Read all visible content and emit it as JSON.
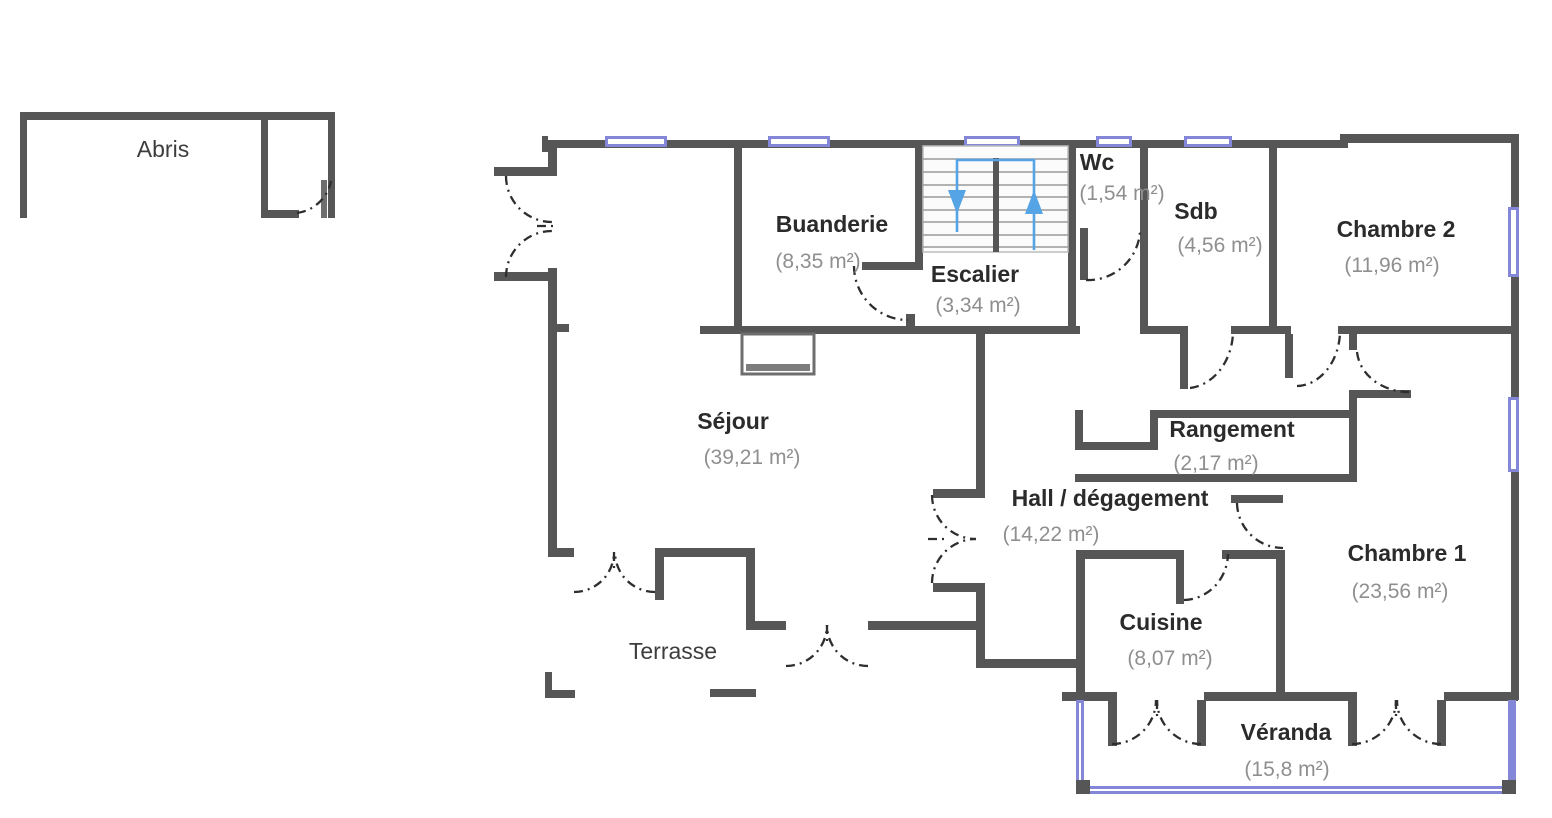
{
  "plan": {
    "outbuilding_label": "Abris",
    "terrace_label": "Terrasse",
    "rooms": [
      {
        "name": "Buanderie",
        "area": "(8,35 m²)"
      },
      {
        "name": "Escalier",
        "area": "(3,34 m²)"
      },
      {
        "name": "Wc",
        "area": "(1,54 m²)"
      },
      {
        "name": "Sdb",
        "area": "(4,56 m²)"
      },
      {
        "name": "Chambre 2",
        "area": "(11,96 m²)"
      },
      {
        "name": "Séjour",
        "area": "(39,21 m²)"
      },
      {
        "name": "Rangement",
        "area": "(2,17 m²)"
      },
      {
        "name": "Hall / dégagement",
        "area": "(14,22 m²)"
      },
      {
        "name": "Chambre 1",
        "area": "(23,56 m²)"
      },
      {
        "name": "Cuisine",
        "area": "(8,07 m²)"
      },
      {
        "name": "Véranda",
        "area": "(15,8 m²)"
      }
    ],
    "colors": {
      "wall": "#565656",
      "window_blue": "#8486d8",
      "stair_arrow_blue": "#55a4e6",
      "room_name": "#2b2b2b",
      "room_area": "#8f8f8f"
    }
  }
}
